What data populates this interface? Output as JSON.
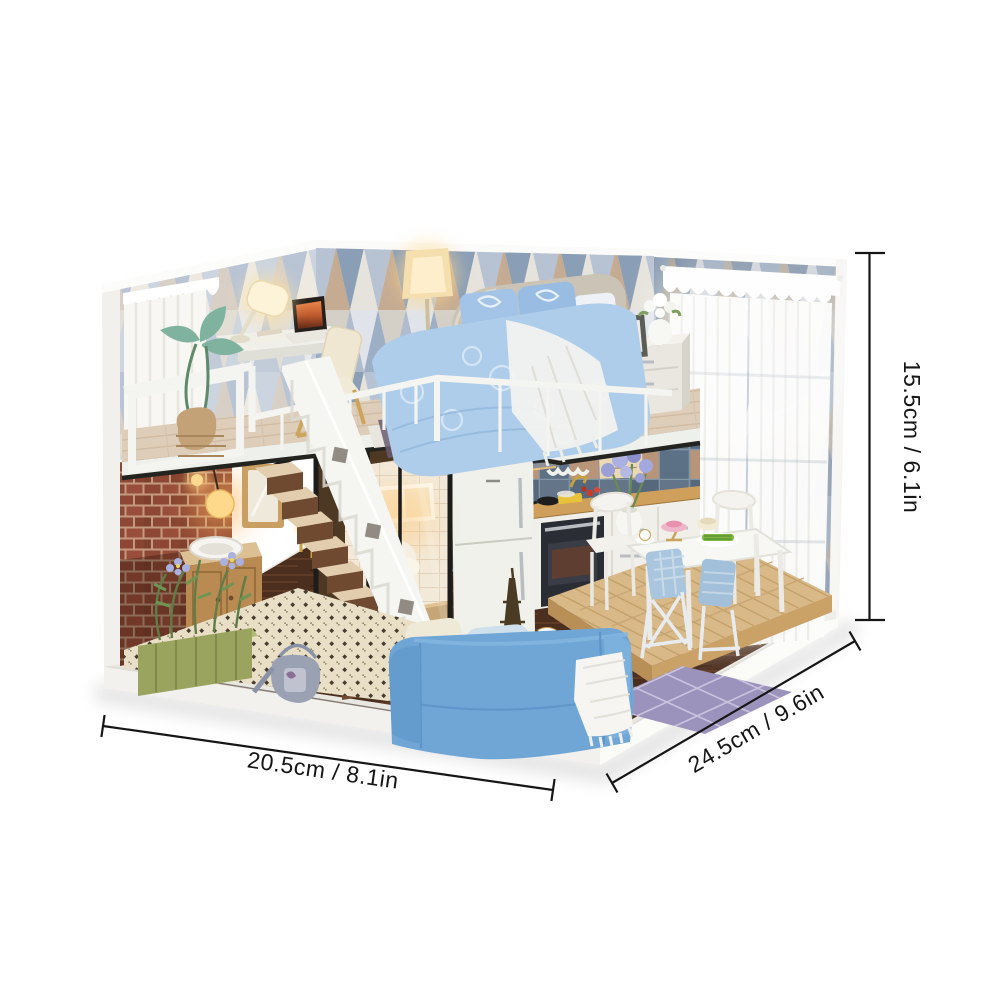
{
  "meta": {
    "title": "Miniature DIY dollhouse loft — product photo with size callouts",
    "background": "#ffffff"
  },
  "dimensions": {
    "height": {
      "label": "15.5cm / 6.1in",
      "cm": 15.5,
      "inches": 6.1,
      "position": "right-vertical"
    },
    "width": {
      "label": "20.5cm / 8.1in",
      "cm": 20.5,
      "inches": 8.1,
      "position": "bottom-left"
    },
    "depth": {
      "label": "24.5cm / 9.6in",
      "cm": 24.5,
      "inches": 9.6,
      "position": "bottom-right"
    }
  },
  "style": {
    "dimension_line_color": "#161616",
    "label_color": "#161616",
    "sofa_blue": "#6fa6d6",
    "bedding_blue": "#aecdea",
    "wallpaper_slate": "#8a9eb6",
    "brick_red": "#8e4734",
    "wood_platform": "#d8b987",
    "dark_floor": "#4c2e1e",
    "warm_light": "#ffd98b"
  },
  "scene": {
    "description": "Two-storey miniature loft: bedroom and study above; kitchen, dining set, glass bathroom, staircase and living area below",
    "objects": [
      "lace-valance",
      "sheer-window-curtain",
      "triangle-wallpaper",
      "writing-desk",
      "desk-lamp",
      "laptop",
      "desk-chair",
      "floor-lamp",
      "bed",
      "throw-pillows",
      "crochet-blanket",
      "nightstand",
      "photo-frame",
      "flower-vase",
      "loft-railing",
      "staircase",
      "brick-wall",
      "wall-lamp",
      "potted-plant",
      "sink-vanity",
      "mirror",
      "glass-partition",
      "toilet",
      "bathroom-window",
      "planter-box",
      "watering-can",
      "fridge",
      "range-hood",
      "kitchen-counter",
      "oven",
      "utensil-wall-print",
      "dining-platform",
      "dining-table",
      "white-dining-chairs",
      "blue-folding-chairs",
      "blue-sofa",
      "fringed-throw",
      "eiffel-tower-figurine",
      "lattice-rug",
      "white-display-base"
    ]
  }
}
